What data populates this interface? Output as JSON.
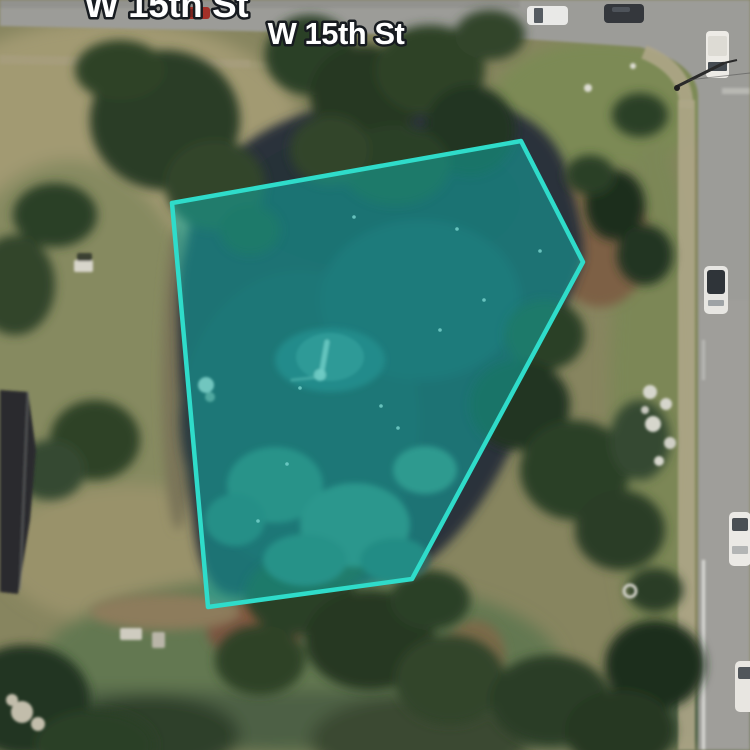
{
  "map": {
    "street_labels": [
      {
        "text": "W 15th St"
      },
      {
        "text": "W 15th St"
      }
    ],
    "overlay": {
      "polygon_points": "172,203 521,141 583,262 412,579 208,607",
      "stroke_color": "#2fdcca",
      "fill_color": "#0fb3ae",
      "fill_opacity": "0.5",
      "stroke_width": "4.5"
    }
  }
}
